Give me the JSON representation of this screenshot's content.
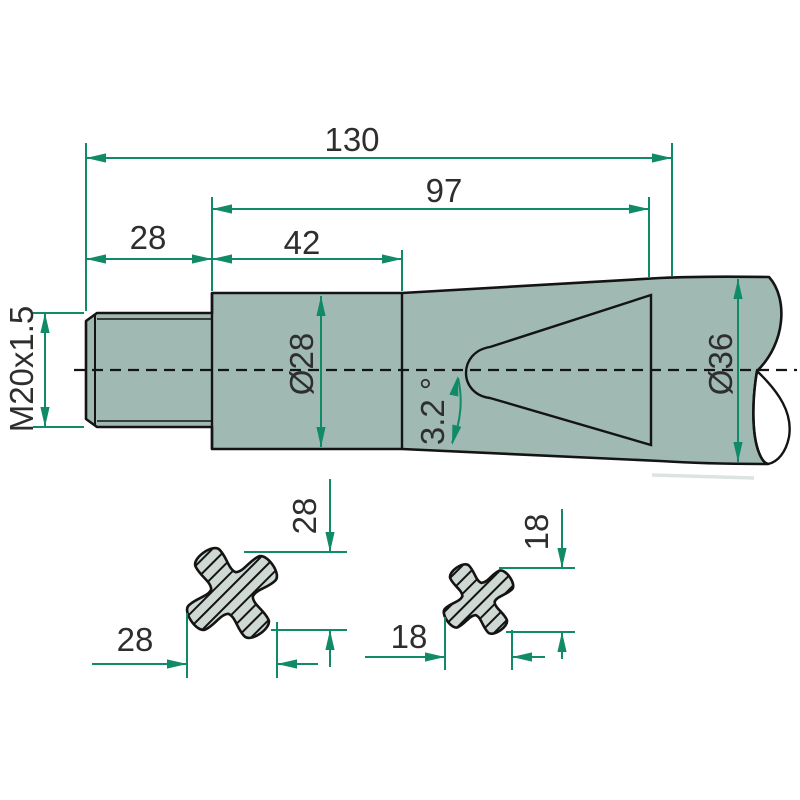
{
  "colors": {
    "line_green": "#108a67",
    "ink": "#2e2e2e",
    "part_fill": "#a0bab3",
    "section_fill": "#cfd9d3",
    "outline": "#141414",
    "background": "#ffffff"
  },
  "drawing": {
    "top_dimensions": {
      "total_length": "130",
      "socket_depth": "97",
      "thread_length": "28",
      "collar_length": "42"
    },
    "side_labels": {
      "thread_spec": "M20x1.5",
      "shaft_diameter": "Ø28",
      "end_diameter": "Ø36",
      "taper_angle": "3.2 °"
    },
    "sections": {
      "large": {
        "width": "28",
        "height": "28"
      },
      "small": {
        "width": "18",
        "height": "18"
      }
    }
  }
}
